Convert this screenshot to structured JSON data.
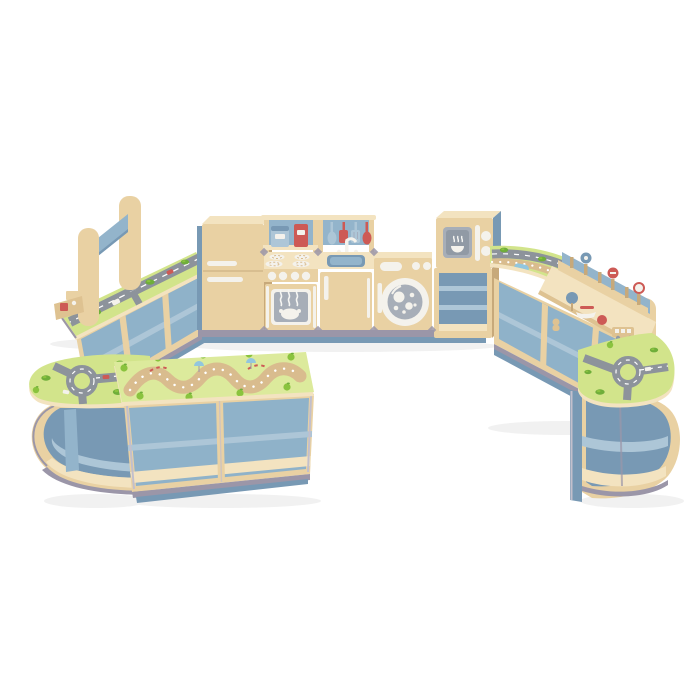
{
  "meta": {
    "type": "product-photo",
    "subject": "Children's wooden role-play furniture set arranged in a U shape on a white background"
  },
  "colors": {
    "wood": "#e9d1a3",
    "wood_light": "#f3e3c0",
    "wood_mid": "#dec291",
    "wood_dark": "#c7a97a",
    "edge": "#9b96a8",
    "edge_light": "#c2bfcc",
    "blue": "#93b4cb",
    "blue_light": "#adc6d7",
    "blue_dark": "#7899b4",
    "blue_interior": "#8fb2c9",
    "white": "#f4f2ec",
    "red": "#cd5a55",
    "screen": "#a7aeb8",
    "screen_dark": "#919aa5",
    "green_top": "#d2e48b",
    "green_top2": "#dcea9c",
    "road": "#8d939b",
    "road_line": "#ffffff",
    "path_tan": "#d9bc8e",
    "pond": "#92c6de",
    "apple": "#8ac33e",
    "leaf": "#6fae3a",
    "shadow": "#f1f1f1",
    "steam": "#f6f6f3"
  },
  "components": {
    "kitchen_row": {
      "fridge": "play fridge with freezer door and two white handles",
      "cooker": "play cooker with splashback shelf, coffee-maker and mixer toys, four burners, four knobs, oven window with roast chicken",
      "sink": "play sink with utensil rail (blue and red utensils), white tap, blue basin",
      "washer": "play washing machine with porthole and bubbles",
      "microwave": "play microwave with steaming-bowl window on an open shelf unit"
    },
    "left_wing": {
      "gantry": "tall wooden frame with blue crossbar",
      "road_counter": "angled counter with road play-top",
      "shelves": "open cubby shelving with blue interior",
      "toy": "small wooden toy on counter"
    },
    "front": {
      "curve_left": "curved corner unit with roundabout road top and curved shelves",
      "bench": "low bench with winding trail game-board top and four cubbies",
      "curve_right": "curved corner unit with roundabout road top and curved shelves"
    },
    "right_wing": {
      "road_top": "curved road-and-river play top",
      "activity_counter": "traffic-sign activity counter with peg rail and wooden toys",
      "end_panel": "rounded wooden end panel",
      "shelves": "open cubby shelving with blue interior"
    }
  }
}
